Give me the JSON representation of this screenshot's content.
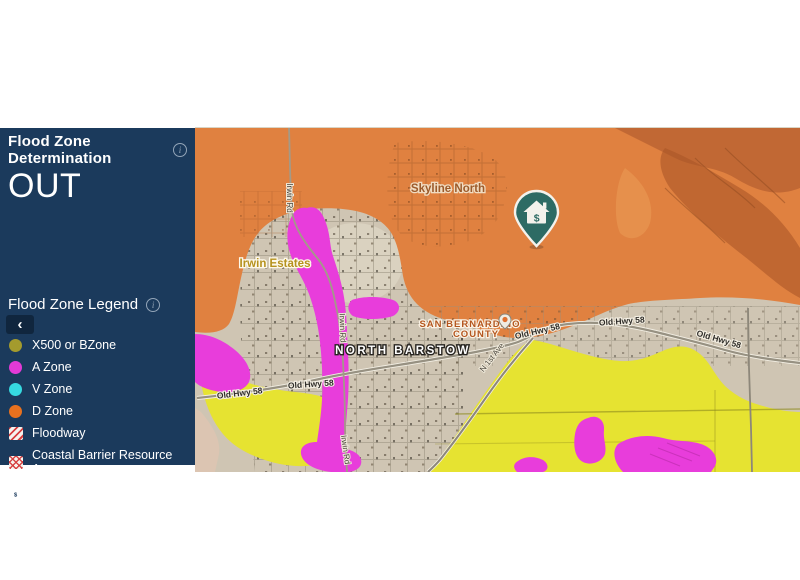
{
  "panel": {
    "background": "#1b3a5c",
    "determination": {
      "title": "Flood Zone Determination",
      "value": "OUT",
      "info_icon": "i"
    },
    "legend": {
      "title": "Flood Zone Legend",
      "info_icon": "i",
      "collapse_icon": "‹",
      "items": [
        {
          "label": "X500 or BZone",
          "swatch": "circle",
          "color": "#a49b2d"
        },
        {
          "label": "A Zone",
          "swatch": "circle",
          "color": "#e33ad6"
        },
        {
          "label": "V Zone",
          "swatch": "circle",
          "color": "#36d9e0"
        },
        {
          "label": "D Zone",
          "swatch": "circle",
          "color": "#e8711f"
        },
        {
          "label": "Floodway",
          "swatch": "diagonal-stripes",
          "color": "#d84040"
        },
        {
          "label": "Coastal Barrier Resource Area",
          "swatch": "crosshatch",
          "color": "#d84040"
        },
        {
          "label": "Subject Property",
          "swatch": "house-icon",
          "color": "#ffffff"
        }
      ]
    }
  },
  "map": {
    "labels": {
      "skyline_north": "Skyline North",
      "irwin_estates": "Irwin Estates",
      "county_line1": "SAN BERNARDINO",
      "county_line2": "COUNTY",
      "north_barstow": "NORTH BARSTOW",
      "old_hwy_58": "Old Hwy 58",
      "irwin_rd": "Irwin Rd",
      "n_1st_ave": "N 1st Ave"
    },
    "zone_colors": {
      "d_zone_orange": "#e08140",
      "x500_yellow": "#e7e431",
      "a_zone_magenta": "#e83ddb",
      "out_tan": "#cfc5b3",
      "pin_teal": "#2d6b64"
    },
    "subject_property_pin": {
      "glyph": "house-dollar",
      "symbol": "$"
    }
  }
}
